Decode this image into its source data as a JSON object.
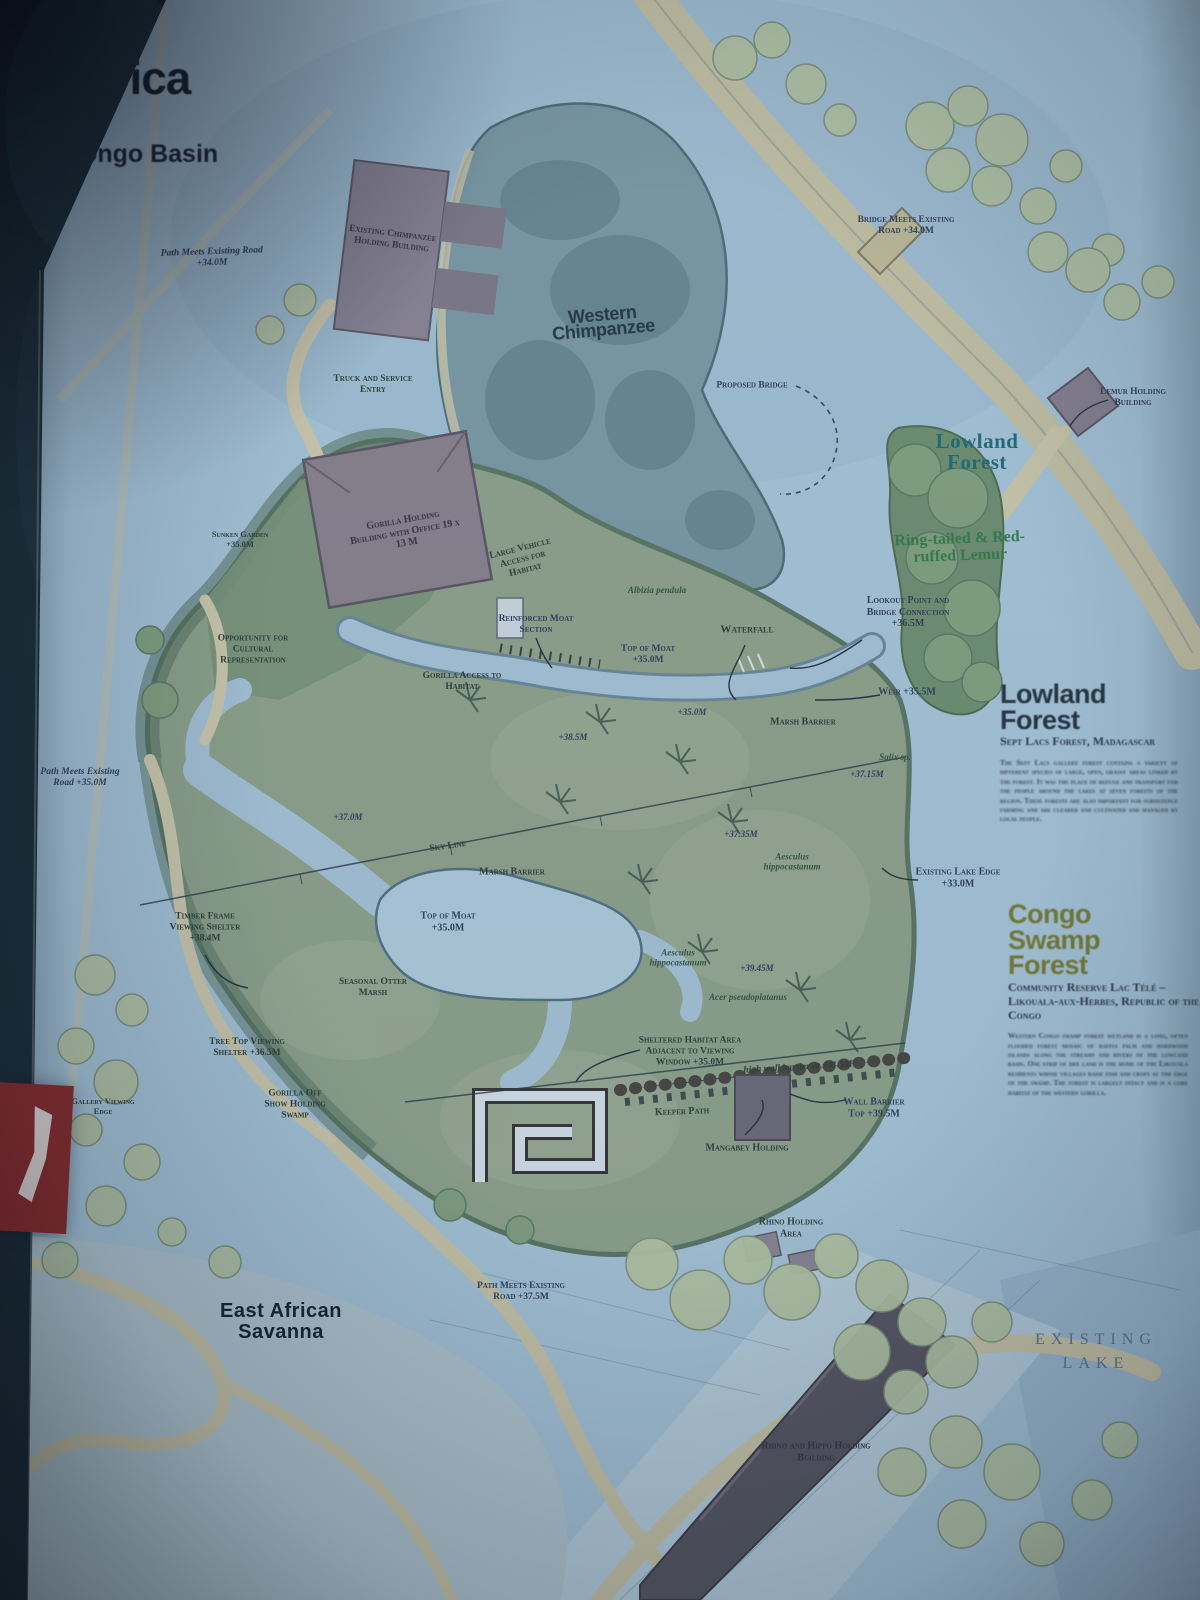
{
  "page": {
    "title": "Africa",
    "subtitle": "Congo Basin"
  },
  "palette": {
    "paper_blue": "#aac6d8",
    "lake_blue": "#9db9ce",
    "exhibit_green": "#90a287",
    "forest_dark": "#5a745e",
    "path_tan": "#d2cbaa",
    "building_mauve": "#8b7f89",
    "building_dark": "#57525c",
    "island_teal": "#7c98a2",
    "tree_pale": "#b7c6a2",
    "accent_teal": "#1d6a72",
    "accent_olive": "#767a2b",
    "accent_green": "#2f7a45",
    "tab_red": "#8a2320",
    "ink": "#243140"
  },
  "annotations": {
    "nw_road": "Path Meets Existing Road +34.0M",
    "existing_chimp_holding": "Existing Chimpanzee Holding Building",
    "truck_entry": "Truck and Service Entry",
    "western_chimpanzee": "Western Chimpanzee",
    "bridge_meets_road": "Bridge Meets Existing Road +34.0M",
    "proposed_bridge": "Proposed Bridge",
    "lowland_forest_map": "Lowland Forest",
    "lemur_holding": "Lemur Holding Building",
    "lemur_species": "Ring-tailed & Red-ruffed Lemur",
    "gorilla_holding": "Gorilla Holding Building with Office 19 x 13 M",
    "large_vehicle_access": "Large Vehicle Access for Habitat",
    "sunken_garden": "Sunken Garden +35.0M",
    "cultural": "Opportunity for Cultural Representation",
    "reinforced_moat": "Reinforced Moat Section",
    "gorilla_access": "Gorilla Access to Habitat",
    "albizia": "Albizia pendula",
    "top_of_moat_n": "Top of Moat +35.0M",
    "waterfall": "Waterfall",
    "lookout": "Lookout Point and Bridge Connection +36.5M",
    "weir": "Weir +35.5M",
    "marsh_barrier_e": "Marsh Barrier",
    "spot_385": "+38.5M",
    "spot_350": "+35.0M",
    "salix": "Salix sp.",
    "spot_3715": "+37.15M",
    "w_road": "Path Meets Existing Road +35.0M",
    "spot_370": "+37.0M",
    "sky_line": "Sky Line",
    "marsh_barrier_c": "Marsh Barrier",
    "aesculus_e": "Aesculus hippocastanum",
    "spot_3735": "+37.35M",
    "lake_edge": "Existing Lake Edge +33.0M",
    "top_of_moat_c": "Top of Moat +35.0M",
    "timber_shelter": "Timber Frame Viewing Shelter +38.4M",
    "otter_marsh": "Seasonal Otter Marsh",
    "aesculus_c": "Aesculus hippocastanum",
    "spot_3945": "+39.45M",
    "acer": "Acer pseudoplatanus",
    "sheltered_habitat": "Sheltered Habitat Area Adjacent to Viewing Window +35.0M",
    "treetop_shelter": "Tree Top Viewing Shelter +36.5M",
    "high_wall": "high wall barrier at +41.5M",
    "keeper_path": "Keeper Path",
    "mangabey_holding": "Mangabey Holding",
    "wall_barrier": "Wall Barrier Top +39.5M",
    "off_show": "Gorilla Off Show Holding Swamp",
    "gallery_edge": "Gallery Viewing Edge",
    "rhino_holding": "Rhino Holding Area",
    "s_road": "Path Meets Existing Road +37.5M",
    "east_african_savanna": "East African Savanna",
    "rhino_hippo_building": "Rhino and Hippo Holding Building",
    "existing_lake": "EXISTING LAKE"
  },
  "panels": {
    "lowland": {
      "title": "Lowland Forest",
      "subtitle": "Sept Lacs Forest, Madagascar",
      "body": "The Sept Lacs gallery forest contains a variety of different species of large, open, grassy areas linked by the forest. It was the place of refuge and transport for the people around the lakes at seven forests of the region. These forests are also important for subsistence farming and are cleared and cultivated and managed by local people."
    },
    "congo": {
      "title": "Congo Swamp Forest",
      "subtitle": "Community Reserve Lac Télé – Likouala-aux-Herbes, Republic of the Congo",
      "body": "Western Congo swamp forest wetland is a long, often flooded forest mosaic of raffia palm and hardwood islands along the streams and rivers of the lowland basin. One strip of dry land is the home of the Likouala residents whose villages raise fish and crops at the edge of the swamp. The forest is largely intact and is a core habitat of the western gorilla."
    }
  }
}
